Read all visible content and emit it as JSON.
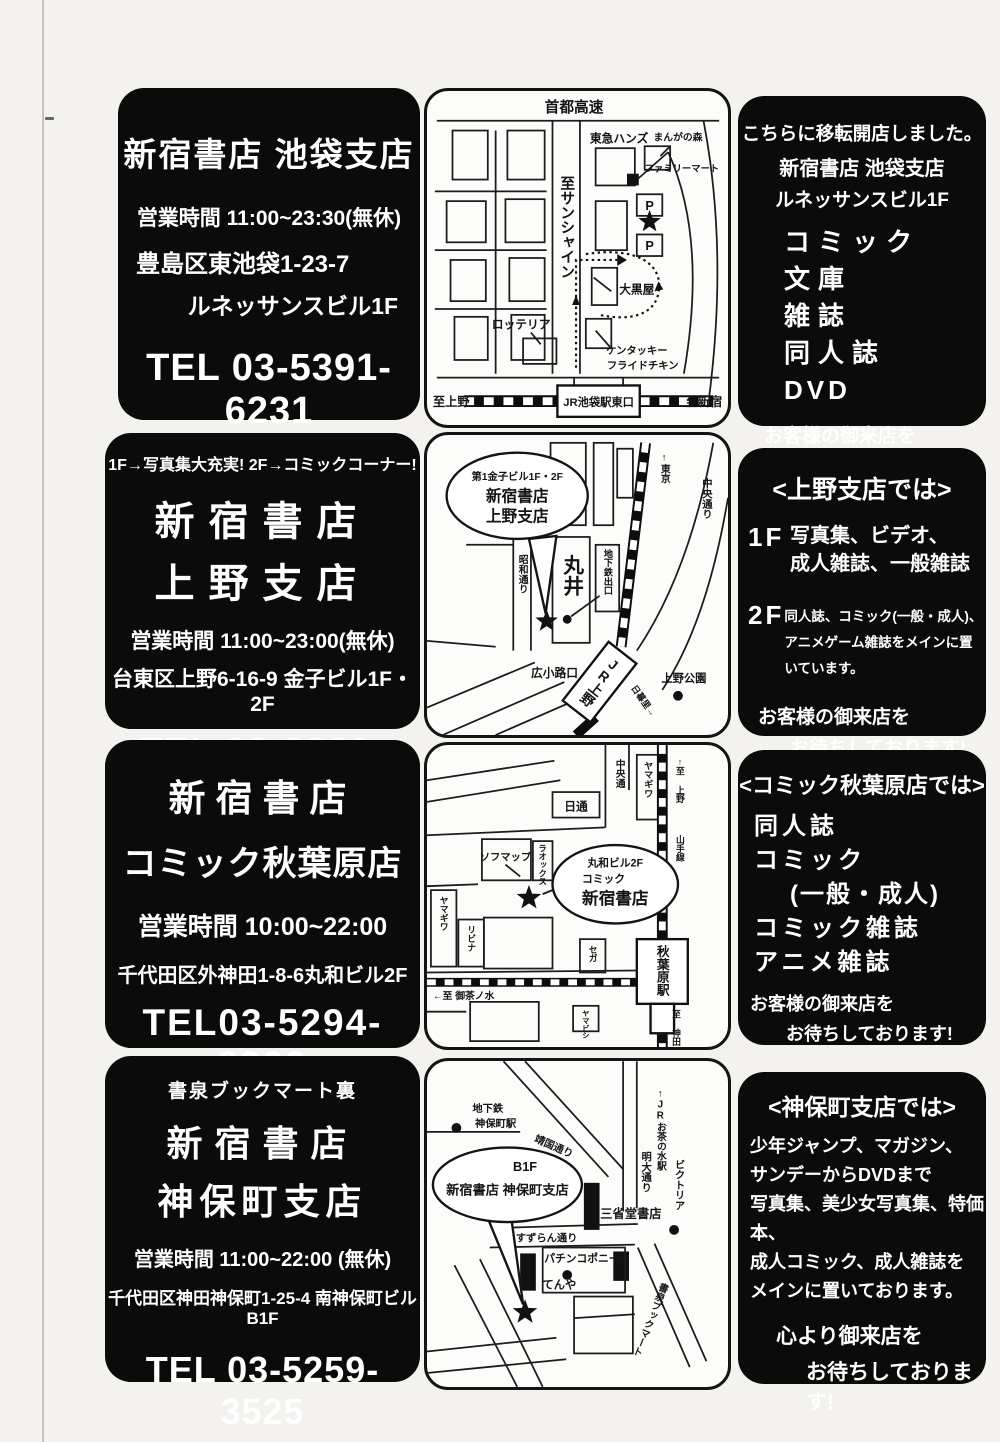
{
  "stores": {
    "ikebukuro": {
      "panel": {
        "title": "新宿書店  池袋支店",
        "hours": "営業時間  11:00~23:30(無休)",
        "address": "豊島区東池袋1-23-7",
        "building": "ルネッサンスビル1F",
        "tel": "TEL 03-5391-6231"
      },
      "info": {
        "moved": "こちらに移転開店しました。",
        "store": "新宿書店 池袋支店",
        "building": "ルネッサンスビル1F",
        "item1": "コミック",
        "item2": "文庫",
        "item3": "雑誌",
        "item4": "同人誌",
        "item5": "DVD",
        "closing1": "お客様の御来店を",
        "closing2": "お待ちしております!"
      },
      "map": {
        "highway": "首都高速",
        "tokyu_hands": "東急ハンズ",
        "manga_mori": "まんがの森",
        "familymart": "ファミリーマート",
        "to_sunshine": "至サンシャイン",
        "p": "P",
        "ooguroya": "大黒屋",
        "lotteria": "ロッテリア",
        "kfc1": "ケンタッキー",
        "kfc2": "フライドチキン",
        "to_ueno": "至上野",
        "station": "JR池袋駅東口",
        "to_shinjuku": "至新宿"
      }
    },
    "ueno": {
      "panel": {
        "banner": "1F→写真集大充実!  2F→コミックコーナー!",
        "title1": "新宿書店",
        "title2": "上野支店",
        "hours": "営業時間  11:00~23:00(無休)",
        "address": "台東区上野6-16-9  金子ビル1F・2F",
        "tel": "TEL 03-3839-5340"
      },
      "info": {
        "header": "<上野支店では>",
        "f1_label": "1F",
        "f1_line1": "写真集、ビデオ、",
        "f1_line2": "成人雑誌、一般雑誌",
        "f2_label": "2F",
        "f2_line1": "同人誌、コミック(一般・成人)、",
        "f2_line2": "アニメゲーム雑誌をメインに置いています。",
        "closing1": "お客様の御来店を",
        "closing2": "お待ちしております!"
      },
      "map": {
        "balloon1": "第1金子ビル1F・2F",
        "balloon2": "新宿書店",
        "balloon3": "上野支店",
        "showa_dori": "昭和通り",
        "marui": "丸井",
        "subway_exit": "地下鉄出口",
        "to_tokyo": "↑東京",
        "chuo_dori": "中央通り",
        "hirokoji": "広小路口",
        "jr_ueno": "JR上野",
        "nippori": "日暮里→",
        "ueno_park": "上野公園"
      }
    },
    "akihabara": {
      "panel": {
        "title1": "新宿書店",
        "title2": "コミック秋葉原店",
        "hours": "営業時間  10:00~22:00",
        "address": "千代田区外神田1-8-6丸和ビル2F",
        "tel": "TEL03-5294-3222"
      },
      "info": {
        "header": "<コミック秋葉原店では>",
        "item1": "同人誌",
        "item2": "コミック",
        "item3": "(一般・成人)",
        "item4": "コミック雑誌",
        "item5": "アニメ雑誌",
        "closing1": "お客様の御来店を",
        "closing2": "お待ちしております!"
      },
      "map": {
        "chuo_dori": "中央通",
        "nittsu": "日通",
        "yamagiwa_top": "ヤマギワ",
        "to_ueno": "↑至 上野",
        "yamanote": "山手線",
        "sofmap": "ソフマップ",
        "laox": "ラオックス",
        "balloon1": "丸和ビル2F",
        "balloon2": "コミック",
        "balloon3": "新宿書店",
        "yamagiwa_left": "ヤマギワ",
        "livina": "リビナ",
        "sega": "セガ",
        "station": "秋葉原駅",
        "to_ochanomizu": "←至 御茶ノ水",
        "yamabishi": "ヤマビシ",
        "to_kanda": "至 神田↓"
      }
    },
    "jimbocho": {
      "panel": {
        "banner": "書泉ブックマート裏",
        "title1": "新宿書店",
        "title2": "神保町支店",
        "hours": "営業時間  11:00~22:00 (無休)",
        "address": "千代田区神田神保町1-25-4  南神保町ビルB1F",
        "tel": "TEL 03-5259-3525"
      },
      "info": {
        "header": "<神保町支店では>",
        "line1": "少年ジャンプ、マガジン、",
        "line2": "サンデーからDVDまで",
        "line3": "写真集、美少女写真集、特価本、",
        "line4": "成人コミック、成人雑誌を",
        "line5": "メインに置いております。",
        "closing1": "心より御来店を",
        "closing2": "お待ちしております!"
      },
      "map": {
        "subway1": "地下鉄",
        "subway2": "神保町駅",
        "yasukuni": "靖国通り",
        "jr_ochanomizu": "↑JRお茶の水駅",
        "meidai": "明大通り",
        "victoria": "ビクトリア",
        "balloon1": "B1F",
        "balloon2": "新宿書店  神保町支店",
        "sanseido": "三省堂書店",
        "suzuran": "すずらん通り",
        "pachinko": "パチンコポニー",
        "tenya": "てんや",
        "shosen": "書泉ブックマート"
      }
    }
  }
}
